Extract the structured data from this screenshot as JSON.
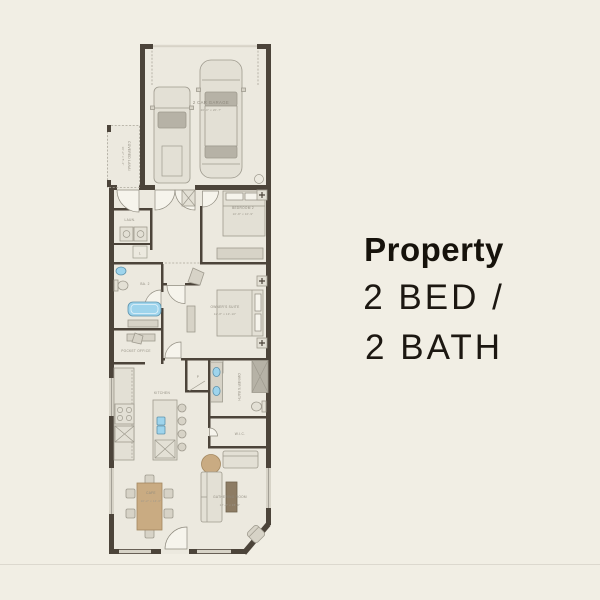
{
  "page": {
    "background_color": "#f1eee4",
    "divider_color": "#dcd8ce"
  },
  "info": {
    "title": "Property",
    "line1": "2 BED /",
    "line2": "2 BATH"
  },
  "floorplan": {
    "wall_color": "#4c443a",
    "floor_color": "#ece9df",
    "fixture_blue": "#9ed4ec",
    "wood_color": "#c9ab82",
    "rooms": [
      {
        "id": "garage",
        "label": "2 CAR GARAGE",
        "dims": "20'-0\" x 20'-7\""
      },
      {
        "id": "covered-lanai",
        "label": "COVERED LANAI",
        "dims": "10'-2\" x 5'-4\""
      },
      {
        "id": "laundry",
        "label": "LAUN."
      },
      {
        "id": "bedroom-2",
        "label": "BEDROOM 2",
        "dims": "10'-8\" x 10'-9\""
      },
      {
        "id": "bath-2",
        "label": "BA. 2"
      },
      {
        "id": "owners-suite",
        "label": "OWNER'S SUITE",
        "dims": "12'-8\" x 13'-10\""
      },
      {
        "id": "pocket-office",
        "label": "POCKET OFFICE"
      },
      {
        "id": "owners-bath",
        "label": "OWNER'S BATH"
      },
      {
        "id": "wic",
        "label": "W.I.C."
      },
      {
        "id": "kitchen",
        "label": "KITCHEN"
      },
      {
        "id": "pantry",
        "label": "P"
      },
      {
        "id": "linen",
        "label": "L"
      },
      {
        "id": "cafe",
        "label": "CAFE",
        "dims": "10'-2\" x 14'-6\""
      },
      {
        "id": "gathering-room",
        "label": "GATHERING ROOM",
        "dims": "12'-8\" x 15'-0\""
      }
    ]
  }
}
